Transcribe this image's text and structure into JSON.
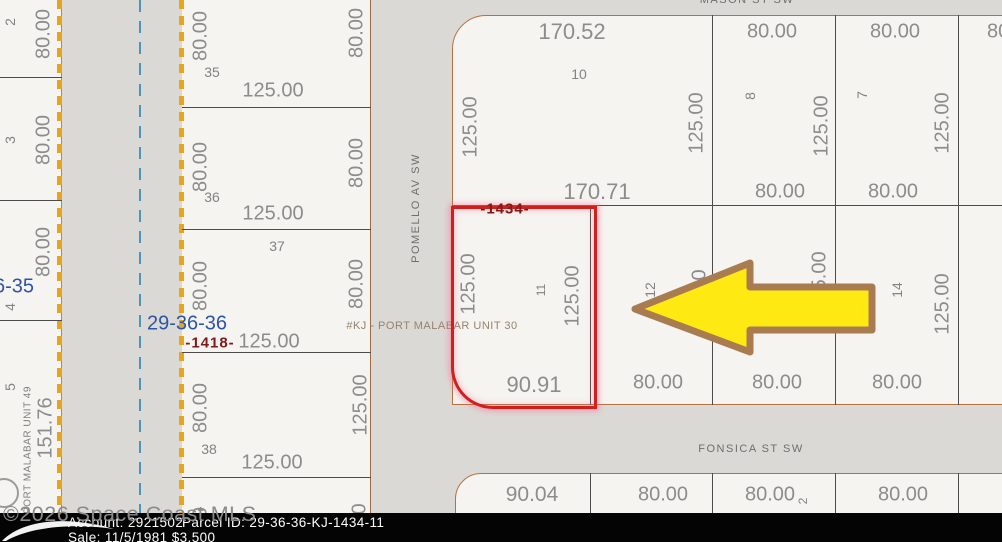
{
  "colors": {
    "subject_outline": "#cf1f1f",
    "arrow_fill": "#ffe913",
    "arrow_stroke": "#a87c50",
    "road_edge_dash": "#e7a51f",
    "road_centerline": "#4e93b8",
    "section_text": "#2d55a5",
    "plat_text": "#7d1a1a",
    "block_outline": "#b5713f"
  },
  "map": {
    "streets": [
      {
        "text": "MASON ST SW",
        "x": 747,
        "y": 0,
        "r": 0
      },
      {
        "text": "POMELLO AV SW",
        "x": 416,
        "y": 208,
        "r": 1
      },
      {
        "text": "FONSICA ST SW",
        "x": 751,
        "y": 449,
        "r": 0
      }
    ],
    "section_labels": [
      {
        "text": "29-36-36",
        "x": 187,
        "y": 324
      },
      {
        "text": "6-35",
        "x": 14,
        "y": 287
      }
    ],
    "plat_labels": [
      {
        "text": "-1418-",
        "x": 210,
        "y": 343
      },
      {
        "text": "-1434-",
        "x": 505,
        "y": 209
      }
    ],
    "unit_labels": [
      {
        "text": "#KJ - PORT MALABAR UNIT 30",
        "x": 432,
        "y": 326,
        "r": 0
      },
      {
        "text": "PORT MALABAR UNIT 49",
        "x": 28,
        "y": 450,
        "r": 1
      }
    ],
    "dimension_labels": [
      {
        "text": "80.00",
        "x": 44,
        "y": 34,
        "r": 1
      },
      {
        "text": "80.00",
        "x": 44,
        "y": 140,
        "r": 1
      },
      {
        "text": "80.00",
        "x": 44,
        "y": 252,
        "r": 1
      },
      {
        "text": "80.00",
        "x": -14,
        "y": 170,
        "r": 1
      },
      {
        "text": "151.76",
        "x": 46,
        "y": 428,
        "r": 1
      },
      {
        "text": "80.00",
        "x": 201,
        "y": 36,
        "r": 1
      },
      {
        "text": "80.00",
        "x": 201,
        "y": 167,
        "r": 1
      },
      {
        "text": "80.00",
        "x": 201,
        "y": 286,
        "r": 1
      },
      {
        "text": "80.00",
        "x": 201,
        "y": 408,
        "r": 1
      },
      {
        "text": "80.00",
        "x": 357,
        "y": 33,
        "r": 1
      },
      {
        "text": "80.00",
        "x": 357,
        "y": 163,
        "r": 1
      },
      {
        "text": "80.00",
        "x": 357,
        "y": 284,
        "r": 1
      },
      {
        "text": "125.00",
        "x": 361,
        "y": 405,
        "r": 1
      },
      {
        "text": "125.00",
        "x": 273,
        "y": 91,
        "r": 0
      },
      {
        "text": "125.00",
        "x": 273,
        "y": 214,
        "r": 0
      },
      {
        "text": "125.00",
        "x": 269,
        "y": 342,
        "r": 0
      },
      {
        "text": "125.00",
        "x": 272,
        "y": 463,
        "r": 0
      },
      {
        "text": "80.00",
        "x": 201,
        "y": 532,
        "r": 1
      },
      {
        "text": "125.00",
        "x": 360,
        "y": 534,
        "r": 1
      },
      {
        "text": "170.52",
        "x": 572,
        "y": 32,
        "r": 0,
        "s": 22
      },
      {
        "text": "125.00",
        "x": 471,
        "y": 127,
        "r": 1
      },
      {
        "text": "125.00",
        "x": 697,
        "y": 123,
        "r": 1
      },
      {
        "text": "170.71",
        "x": 597,
        "y": 192,
        "r": 0,
        "s": 22
      },
      {
        "text": "80.00",
        "x": 772,
        "y": 32,
        "r": 0
      },
      {
        "text": "125.00",
        "x": 822,
        "y": 126,
        "r": 1
      },
      {
        "text": "80.00",
        "x": 780,
        "y": 192,
        "r": 0
      },
      {
        "text": "80.00",
        "x": 895,
        "y": 32,
        "r": 0
      },
      {
        "text": "125.00",
        "x": 943,
        "y": 123,
        "r": 1
      },
      {
        "text": "80.00",
        "x": 893,
        "y": 192,
        "r": 0
      },
      {
        "text": "80.00",
        "x": 1012,
        "y": 32,
        "r": 0
      },
      {
        "text": "125.00",
        "x": 469,
        "y": 284,
        "r": 1
      },
      {
        "text": "125.00",
        "x": 573,
        "y": 296,
        "r": 1
      },
      {
        "text": "90.91",
        "x": 534,
        "y": 385,
        "r": 0,
        "s": 22
      },
      {
        "text": "80.00",
        "x": 658,
        "y": 383,
        "r": 0
      },
      {
        "text": "125.00",
        "x": 700,
        "y": 300,
        "r": 1
      },
      {
        "text": "125.00",
        "x": 820,
        "y": 282,
        "r": 1
      },
      {
        "text": "80.00",
        "x": 777,
        "y": 383,
        "r": 0
      },
      {
        "text": "125.00",
        "x": 943,
        "y": 304,
        "r": 1
      },
      {
        "text": "80.00",
        "x": 897,
        "y": 383,
        "r": 0
      },
      {
        "text": "90.04",
        "x": 532,
        "y": 495,
        "r": 0,
        "s": 21
      },
      {
        "text": "80.00",
        "x": 663,
        "y": 495,
        "r": 0
      },
      {
        "text": "80.00",
        "x": 770,
        "y": 495,
        "r": 0
      },
      {
        "text": "80.00",
        "x": 903,
        "y": 495,
        "r": 0
      }
    ],
    "lot_numbers": [
      {
        "text": "2",
        "x": 10,
        "y": 22,
        "r": 1
      },
      {
        "text": "3",
        "x": 10,
        "y": 140,
        "r": 1
      },
      {
        "text": "4",
        "x": 10,
        "y": 307,
        "r": 1
      },
      {
        "text": "5",
        "x": 10,
        "y": 387,
        "r": 1
      },
      {
        "text": "35",
        "x": 212,
        "y": 72,
        "r": 0
      },
      {
        "text": "36",
        "x": 212,
        "y": 197,
        "r": 0
      },
      {
        "text": "37",
        "x": 277,
        "y": 246,
        "r": 0
      },
      {
        "text": "38",
        "x": 209,
        "y": 449,
        "r": 0
      },
      {
        "text": "10",
        "x": 579,
        "y": 74,
        "r": 0
      },
      {
        "text": "8",
        "x": 750,
        "y": 96,
        "r": 1
      },
      {
        "text": "7",
        "x": 862,
        "y": 95,
        "r": 1
      },
      {
        "text": "11",
        "x": 541,
        "y": 290,
        "r": 1,
        "s": 12
      },
      {
        "text": "12",
        "x": 650,
        "y": 290,
        "r": 1
      },
      {
        "text": "14",
        "x": 897,
        "y": 290,
        "r": 1
      },
      {
        "text": "2",
        "x": 803,
        "y": 501,
        "r": 1,
        "s": 12
      }
    ]
  },
  "watermark": {
    "text": "©2026 Space Coast MLS"
  },
  "info_bar": {
    "account": "Account: 2921502",
    "parcel_id": "Parcel ID: 29-36-36-KJ-1434-11",
    "sale": "Sale: 11/5/1981 $3,500"
  }
}
